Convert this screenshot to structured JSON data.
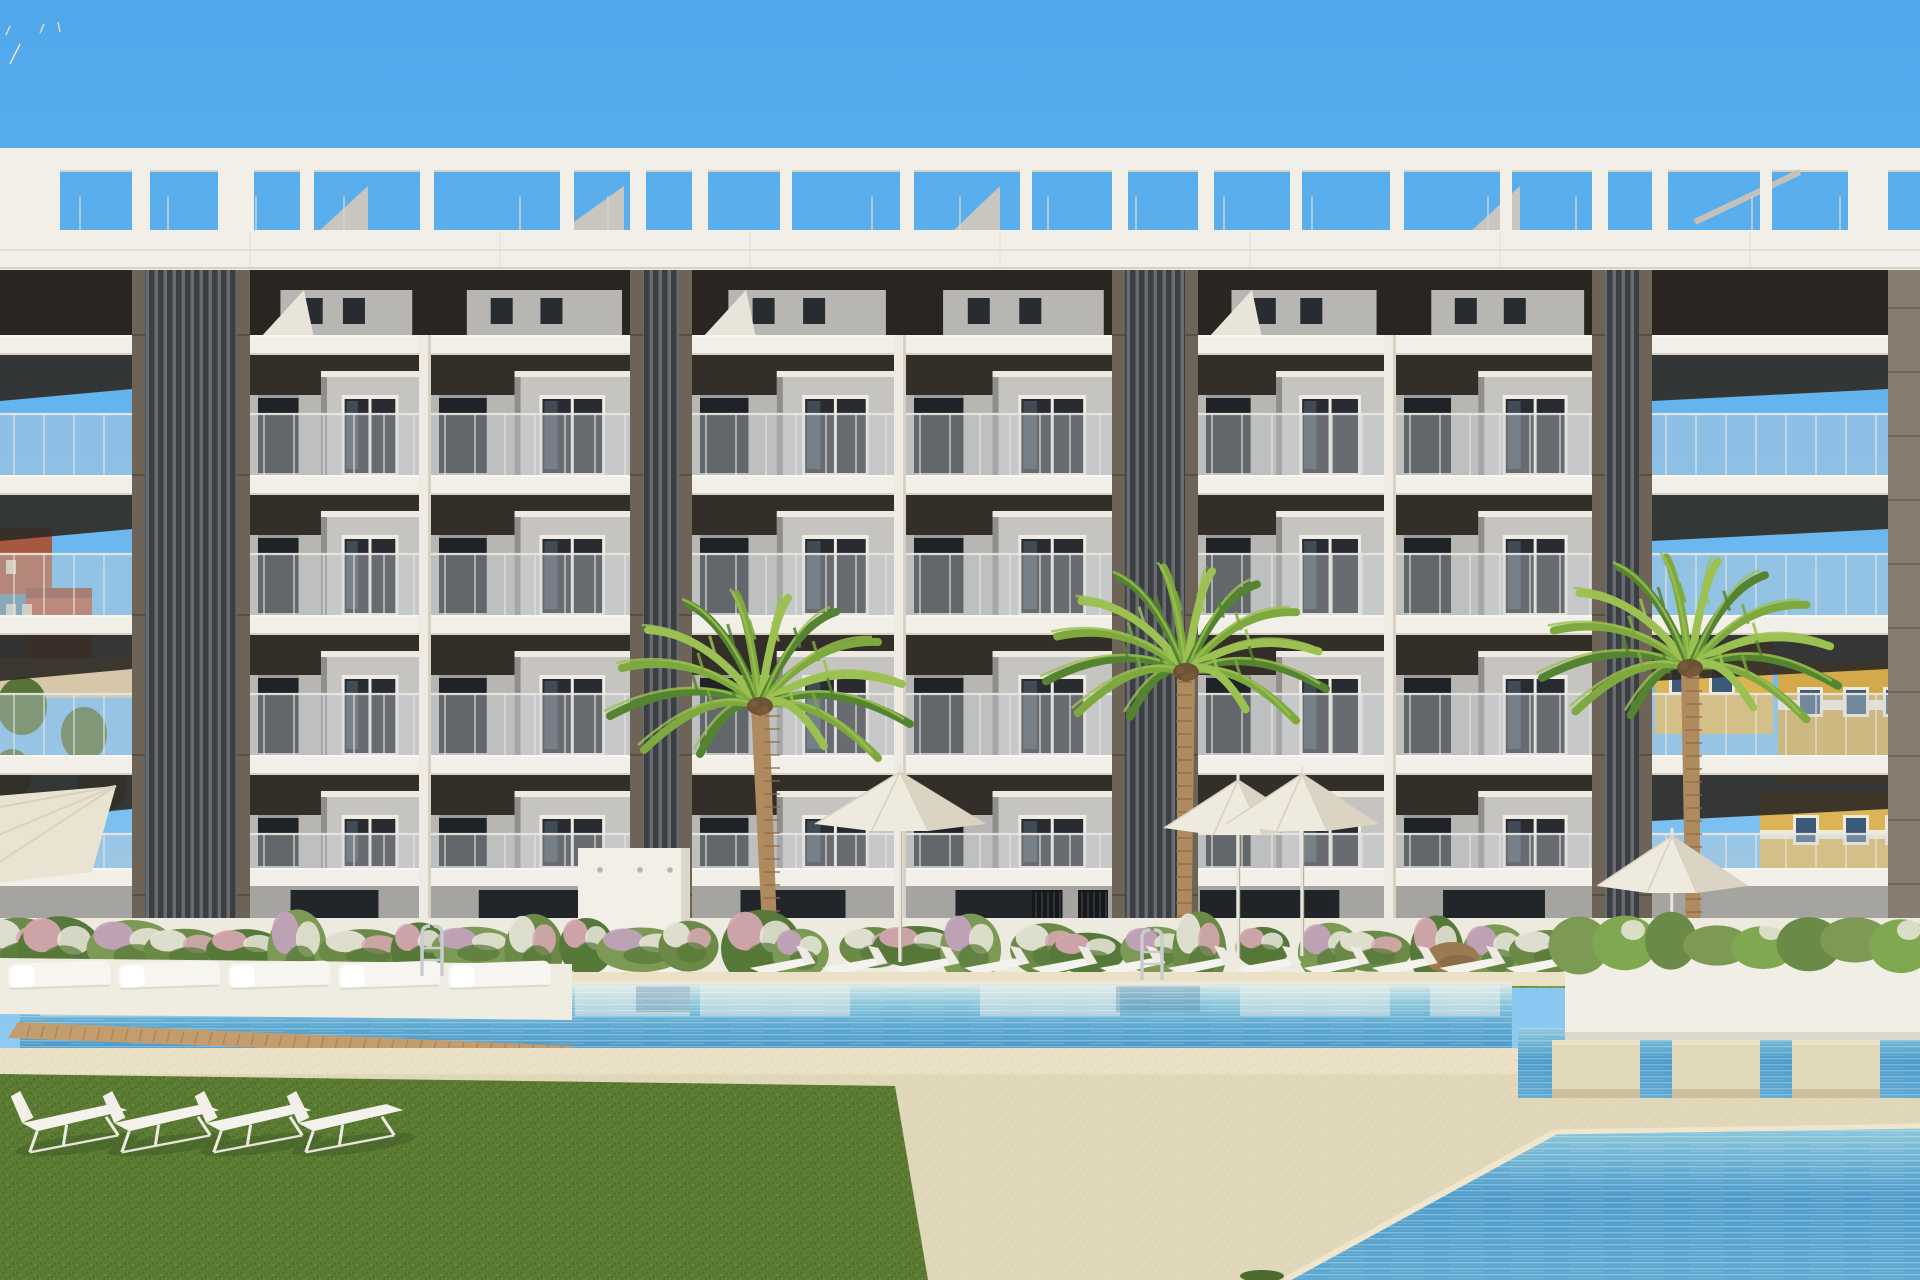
{
  "meta": {
    "title": "New-build apartment complex with communal pools - architectural render",
    "kind": "3d-render-photo"
  },
  "scene": {
    "width": 1920,
    "height": 1280,
    "palette": {
      "sky_top": "#4FA8EB",
      "sky_low": "#A6D6F3",
      "white": "#F2EFE8",
      "white_dim": "#E6E2D7",
      "slab_edge": "#D7D1C3",
      "shadow_dark": "#332E27",
      "attic_dark": "#2A2520",
      "wall": "#B8B6B3",
      "wall_light": "#C6C4C1",
      "wall_shade": "#908E8B",
      "win_dark": "#282B30",
      "win_frame": "#EFECE5",
      "win_refl": "#5E7386",
      "glass": "#C7D0D4",
      "glass_line": "#E9E7E1",
      "core_trim": "#6E6357",
      "slat_a": "#3B3E42",
      "slat_b": "#686B70",
      "pillar": "#867C70",
      "ground_wall": "#A6A4A1",
      "door": "#22252A",
      "gate": "#16181C",
      "wall_white": "#EDEADF",
      "wall_white_sh": "#D9D3C2",
      "grass_strip": "#7E9D50",
      "grass": "#5B7B33",
      "grass_dark": "#3E5B26",
      "sand": "#E1D7B9",
      "sand_light": "#EAE1C6",
      "sand_shade": "#CCC09E",
      "water_pale": "#D8E8E9",
      "water_mid": "#8FC9DC",
      "water": "#5FAAD2",
      "water_deep": "#4E9CCB",
      "refl_white": "#EDEFE9",
      "refl_dark": "#47789A",
      "wood": "#C49D6E",
      "wood_dark": "#A37E52",
      "white_furn": "#F5F3ED",
      "furn_shade": "#DDD8CC",
      "canopy": "#EFEADE",
      "canopy_shade": "#DCD4C2",
      "chrome": "#C8CDD1",
      "trunk": "#AE8A5E",
      "trunk_dark": "#8F6C47",
      "palm_dark": "#558431",
      "palm_mid": "#7DA93F",
      "palm_light": "#9CC153",
      "crown": "#6B5336",
      "hedge1": "#6B8A48",
      "hedge2": "#567838",
      "hedge3": "#7C9A54",
      "flw_white": "#EAE7DC",
      "flw_pink": "#D9A9B4",
      "flw_mauve": "#C4A3C0",
      "planter_white": "#F1EEE5",
      "bg_red": "#A85840",
      "bg_brick": "#B45A42",
      "bg_teal": "#5E8FA8",
      "bg_cream": "#D6C7A8",
      "bg_yellow": "#DCB455",
      "bg_yellow2": "#D3A94A",
      "bg_win": "#3A5A78",
      "tree": "#4F7030",
      "boulder": "#9A7A50"
    },
    "background": {
      "left": [
        {
          "r": [
            0,
            528,
            52,
            98
          ],
          "c": "bg_red"
        },
        {
          "r": [
            0,
            594,
            46,
            74
          ],
          "c": "bg_teal"
        },
        {
          "r": [
            26,
            588,
            66,
            86
          ],
          "c": "bg_brick"
        },
        {
          "r": [
            0,
            658,
            132,
            40
          ],
          "c": "bg_cream"
        }
      ],
      "left_trees": [
        [
          22,
          706,
          50,
          58
        ],
        [
          84,
          734,
          46,
          54
        ],
        [
          12,
          774,
          40,
          50
        ],
        [
          102,
          784,
          50,
          58
        ],
        [
          62,
          934,
          68,
          58
        ],
        [
          6,
          956,
          48,
          48
        ]
      ],
      "right": [
        {
          "r": [
            1655,
            642,
            118,
            92
          ],
          "c": "bg_yellow"
        },
        {
          "r": [
            1778,
            662,
            142,
            122
          ],
          "c": "bg_yellow2"
        },
        {
          "r": [
            1760,
            792,
            160,
            118
          ],
          "c": "bg_yellow"
        },
        {
          "r": [
            1650,
            884,
            270,
            36
          ],
          "c": "bg_cream"
        }
      ],
      "right_windows": [
        [
          1672,
          668
        ],
        [
          1712,
          668
        ],
        [
          1800,
          690
        ],
        [
          1846,
          690
        ],
        [
          1886,
          690
        ],
        [
          1796,
          818
        ],
        [
          1846,
          818
        ],
        [
          1888,
          818
        ]
      ],
      "right_trees": [
        [
          1862,
          904,
          66,
          66
        ],
        [
          1904,
          952,
          56,
          56
        ]
      ]
    },
    "building": {
      "x_end": 1888,
      "pergola": {
        "beam": [
          0,
          148,
          1920,
          24
        ],
        "open_y": [
          172,
          232
        ],
        "posts": [
          [
            -10,
            70
          ],
          [
            132,
            18
          ],
          [
            218,
            36
          ],
          [
            300,
            14
          ],
          [
            420,
            14
          ],
          [
            560,
            14
          ],
          [
            630,
            16
          ],
          [
            692,
            16
          ],
          [
            780,
            12
          ],
          [
            900,
            14
          ],
          [
            1020,
            12
          ],
          [
            1112,
            16
          ],
          [
            1198,
            16
          ],
          [
            1290,
            12
          ],
          [
            1390,
            14
          ],
          [
            1500,
            12
          ],
          [
            1592,
            16
          ],
          [
            1652,
            16
          ],
          [
            1760,
            12
          ],
          [
            1848,
            40
          ]
        ],
        "ticks_step": 88,
        "bulkheads": [
          [
            318,
            368
          ],
          [
            560,
            624
          ],
          [
            952,
            1000
          ],
          [
            1470,
            1520
          ]
        ],
        "rail": [
          1695,
          222,
          1800,
          172
        ]
      },
      "fascia": [
        0,
        230,
        1920,
        40
      ],
      "attic": [
        0,
        268,
        1888,
        70
      ],
      "slabs": [
        335,
        475,
        615,
        755,
        868
      ],
      "slab_h": 20,
      "floors": [
        [
          355,
          120
        ],
        [
          495,
          120
        ],
        [
          635,
          120
        ],
        [
          775,
          93
        ]
      ],
      "shadow_h": 40,
      "bays": [
        [
          0,
          132,
          "open"
        ],
        [
          250,
          419,
          "wall"
        ],
        [
          431,
          630,
          "wall"
        ],
        [
          692,
          894,
          "wall"
        ],
        [
          906,
          1112,
          "wall"
        ],
        [
          1198,
          1384,
          "wall"
        ],
        [
          1396,
          1592,
          "wall"
        ],
        [
          1652,
          1888,
          "open"
        ]
      ],
      "columns": [
        [
          419,
          12
        ],
        [
          894,
          12
        ],
        [
          1384,
          12
        ]
      ],
      "cores": [
        [
          132,
          118
        ],
        [
          630,
          62
        ],
        [
          1112,
          86
        ],
        [
          1592,
          60
        ]
      ],
      "core_trim_w": 13,
      "right_pillar": [
        1888,
        268,
        32,
        772
      ],
      "ground": {
        "y": 886,
        "h": 80,
        "door_y": [
          890,
          962
        ],
        "gates": [
          [
            1032,
            1062
          ],
          [
            1078,
            1108
          ]
        ],
        "opening": [
          1200,
          1330
        ]
      }
    },
    "grounds": {
      "grass_strip": [
        0,
        942,
        1920,
        46
      ],
      "wall": [
        0,
        918,
        1920,
        67
      ],
      "hedge": {
        "count": 28,
        "step": 57,
        "base_y": 950
      },
      "sand_far": [
        0,
        972,
        1920,
        14
      ],
      "pool": {
        "x": [
          20,
          1512
        ],
        "y": [
          984,
          1048
        ],
        "streaks": [
          [
            40,
            190
          ],
          [
            320,
            210
          ],
          [
            575,
            115
          ],
          [
            700,
            150
          ],
          [
            980,
            140
          ],
          [
            1240,
            150
          ],
          [
            1430,
            70
          ]
        ],
        "dark": [
          [
            150,
            80
          ],
          [
            636,
            54
          ],
          [
            1116,
            84
          ]
        ]
      },
      "wood_edge": [
        [
          18,
          1022
        ],
        [
          572,
          1046
        ],
        [
          572,
          1060
        ],
        [
          8,
          1038
        ]
      ],
      "platform": [
        [
          0,
          958
        ],
        [
          572,
          964
        ],
        [
          572,
          1020
        ],
        [
          0,
          1014
        ]
      ],
      "daybeds": {
        "xs": [
          8,
          118,
          228,
          338,
          448
        ],
        "y": 964,
        "w": 102,
        "h": 26
      },
      "deck": [
        0,
        1048,
        1920,
        232
      ],
      "channel": [
        1518,
        1028,
        402,
        70
      ],
      "platforms": {
        "xs": [
          1552,
          1672,
          1792
        ],
        "w": 88,
        "y": 1040,
        "h": 58
      },
      "planter": [
        1565,
        948,
        355,
        92
      ],
      "br_pool": [
        [
          1285,
          1280
        ],
        [
          1555,
          1132
        ],
        [
          1920,
          1126
        ],
        [
          1920,
          1280
        ]
      ],
      "fg_grass": [
        [
          0,
          1074
        ],
        [
          600,
          1082
        ],
        [
          895,
          1086
        ],
        [
          928,
          1280
        ],
        [
          0,
          1280
        ]
      ],
      "grass_tuft": [
        1262,
        1276,
        44,
        12
      ]
    },
    "furniture": {
      "shower_wall": [
        578,
        848,
        112,
        160
      ],
      "mid_loungers": {
        "xs": [
          748,
          820,
          892,
          962,
          1030,
          1098,
          1166,
          1234,
          1302,
          1370,
          1438,
          1504
        ],
        "y": 948
      },
      "fg_loungers": {
        "xs": [
          12,
          104,
          196,
          288
        ],
        "y": 1090
      },
      "umbrellas": [
        {
          "cx": 900,
          "top": 772,
          "w": 170,
          "h": 52,
          "pole_y": 962
        },
        {
          "cx": 1238,
          "top": 780,
          "w": 148,
          "h": 48,
          "pole_y": 958
        },
        {
          "cx": 1302,
          "top": 774,
          "w": 152,
          "h": 50,
          "pole_y": 956
        },
        {
          "cx": 1672,
          "top": 836,
          "w": 150,
          "h": 50,
          "pole_y": 960
        }
      ],
      "umbrella_left": [
        [
          -28,
          798
        ],
        [
          116,
          786
        ],
        [
          92,
          872
        ],
        [
          -28,
          886
        ]
      ],
      "ladders": [
        [
          432,
          930
        ],
        [
          1152,
          934
        ]
      ],
      "boulder": [
        1452,
        958,
        27,
        16
      ]
    },
    "palms": [
      {
        "crown": [
          760,
          706
        ],
        "r": 150,
        "base": [
          772,
          988
        ]
      },
      {
        "crown": [
          1186,
          672
        ],
        "r": 140,
        "base": [
          1184,
          962
        ]
      },
      {
        "crown": [
          1690,
          668
        ],
        "r": 148,
        "base": [
          1694,
          1002
        ]
      }
    ]
  }
}
